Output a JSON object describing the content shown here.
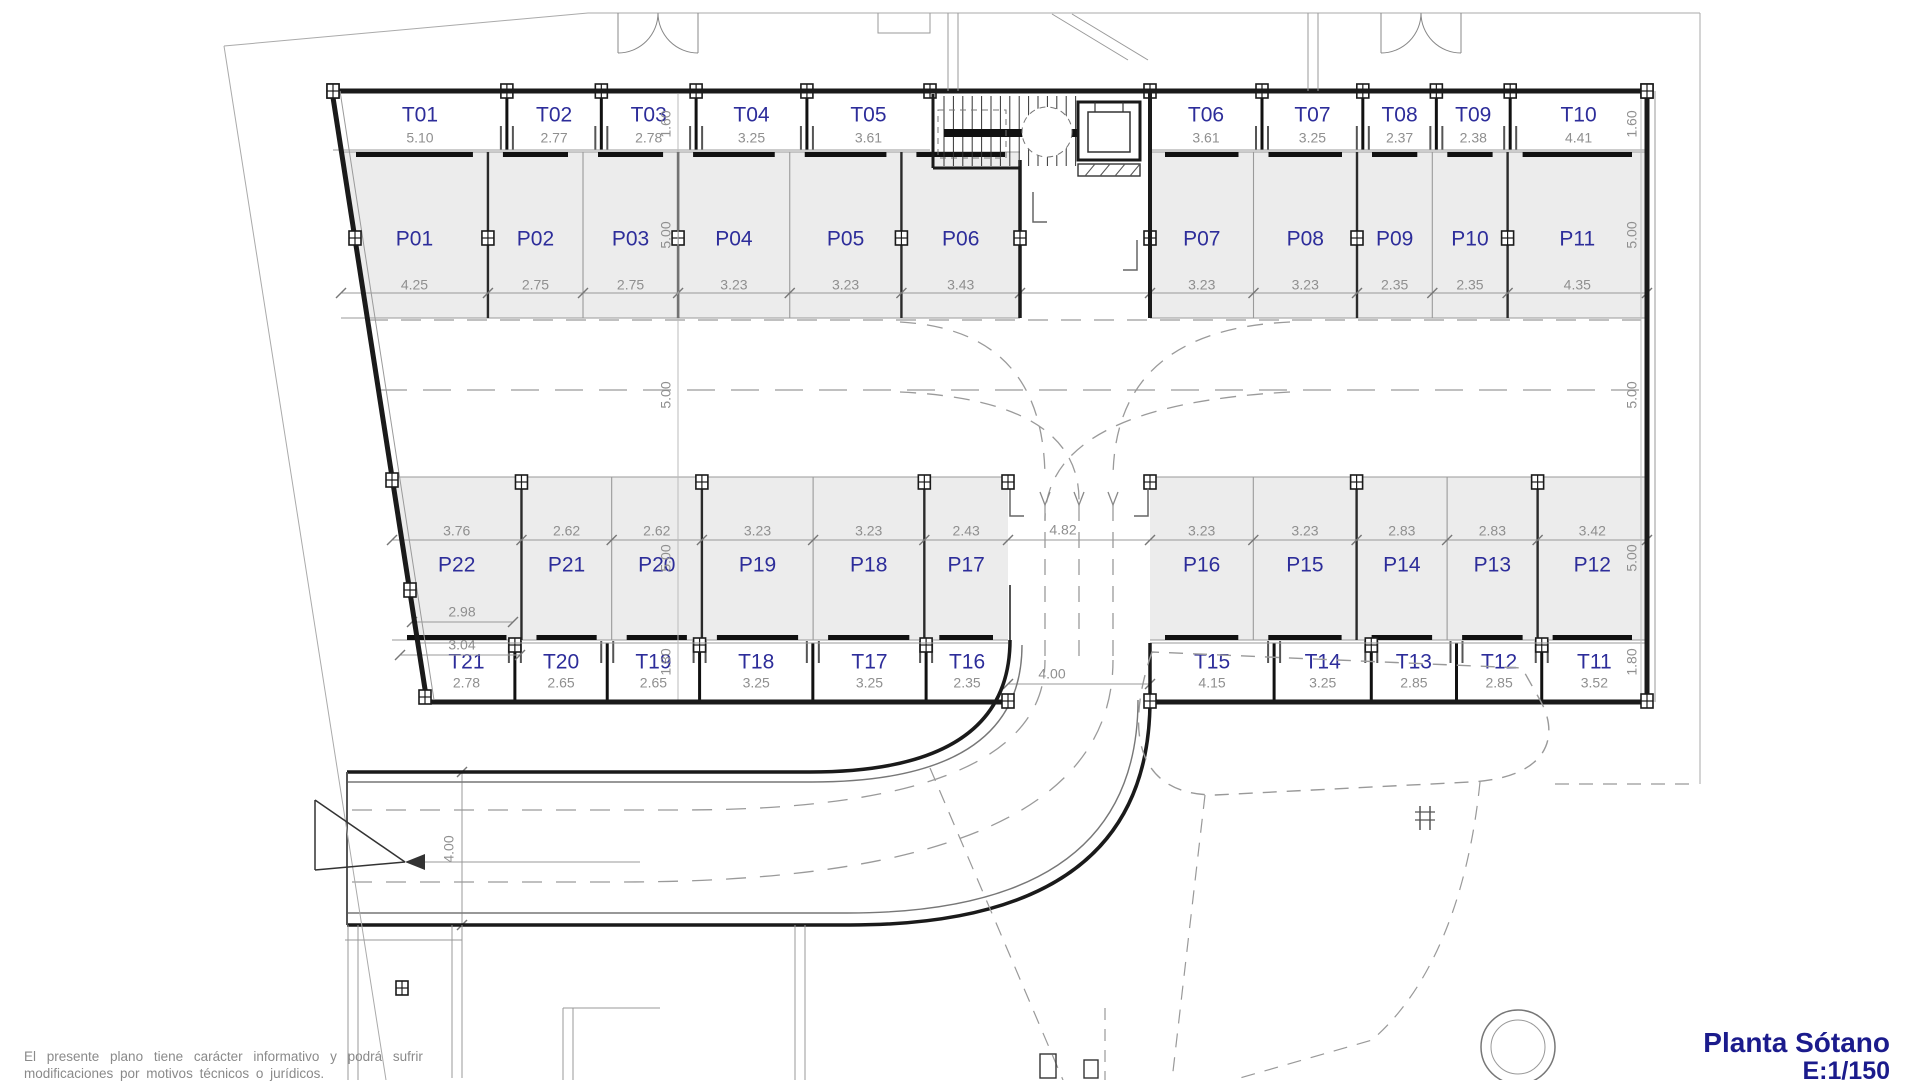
{
  "plan": {
    "title": "Planta Sótano",
    "scale": "E:1/150",
    "disclaimer_line1": "El presente plano tiene carácter informativo y podrá sufrir",
    "disclaimer_line2": "modificaciones por motivos técnicos o jurídicos."
  },
  "bands": {
    "top_storage_left": [
      {
        "id": "T01",
        "dim": "5.10"
      },
      {
        "id": "T02",
        "dim": "2.77"
      },
      {
        "id": "T03",
        "dim": "2.78"
      },
      {
        "id": "T04",
        "dim": "3.25"
      },
      {
        "id": "T05",
        "dim": "3.61"
      }
    ],
    "top_storage_right": [
      {
        "id": "T06",
        "dim": "3.61"
      },
      {
        "id": "T07",
        "dim": "3.25"
      },
      {
        "id": "T08",
        "dim": "2.37"
      },
      {
        "id": "T09",
        "dim": "2.38"
      },
      {
        "id": "T10",
        "dim": "4.41"
      }
    ],
    "top_parking_left": [
      {
        "id": "P01",
        "dim": "4.25"
      },
      {
        "id": "P02",
        "dim": "2.75"
      },
      {
        "id": "P03",
        "dim": "2.75"
      },
      {
        "id": "P04",
        "dim": "3.23"
      },
      {
        "id": "P05",
        "dim": "3.23"
      },
      {
        "id": "P06",
        "dim": "3.43"
      }
    ],
    "top_parking_right": [
      {
        "id": "P07",
        "dim": "3.23"
      },
      {
        "id": "P08",
        "dim": "3.23"
      },
      {
        "id": "P09",
        "dim": "2.35"
      },
      {
        "id": "P10",
        "dim": "2.35"
      },
      {
        "id": "P11",
        "dim": "4.35"
      }
    ],
    "bottom_parking_left": [
      {
        "id": "P22",
        "dim": "3.76"
      },
      {
        "id": "P21",
        "dim": "2.62"
      },
      {
        "id": "P20",
        "dim": "2.62"
      },
      {
        "id": "P19",
        "dim": "3.23"
      },
      {
        "id": "P18",
        "dim": "3.23"
      },
      {
        "id": "P17",
        "dim": "2.43"
      }
    ],
    "bottom_parking_right": [
      {
        "id": "P16",
        "dim": "3.23"
      },
      {
        "id": "P15",
        "dim": "3.23"
      },
      {
        "id": "P14",
        "dim": "2.83"
      },
      {
        "id": "P13",
        "dim": "2.83"
      },
      {
        "id": "P12",
        "dim": "3.42"
      }
    ],
    "bottom_storage_left": [
      {
        "id": "T21",
        "dim": "2.78"
      },
      {
        "id": "T20",
        "dim": "2.65"
      },
      {
        "id": "T19",
        "dim": "2.65"
      },
      {
        "id": "T18",
        "dim": "3.25"
      },
      {
        "id": "T17",
        "dim": "3.25"
      },
      {
        "id": "T16",
        "dim": "2.35"
      }
    ],
    "bottom_storage_right": [
      {
        "id": "T15",
        "dim": "4.15"
      },
      {
        "id": "T14",
        "dim": "3.25"
      },
      {
        "id": "T13",
        "dim": "2.85"
      },
      {
        "id": "T12",
        "dim": "2.85"
      },
      {
        "id": "T11",
        "dim": "3.52"
      }
    ]
  },
  "dimension_chains": {
    "left": [
      "1.60",
      "5.00",
      "5.00",
      "5.00",
      "1.80"
    ],
    "right": [
      "1.60",
      "5.00",
      "5.00",
      "5.00",
      "1.80"
    ]
  },
  "extra_dimensions": {
    "aisle_entry_width": "4.82",
    "corridor_bottom_width": "4.00",
    "ramp_width": "4.00",
    "p22_depth_1": "2.98",
    "p22_depth_2": "3.04"
  },
  "colors": {
    "room_label": "#2d2d9a",
    "dimension_text": "#8f8f8f",
    "wall": "#1a1a1a",
    "thin_line": "#9a9a9a",
    "stall_fill": "#ececec",
    "title_text": "#1b1b8c"
  }
}
